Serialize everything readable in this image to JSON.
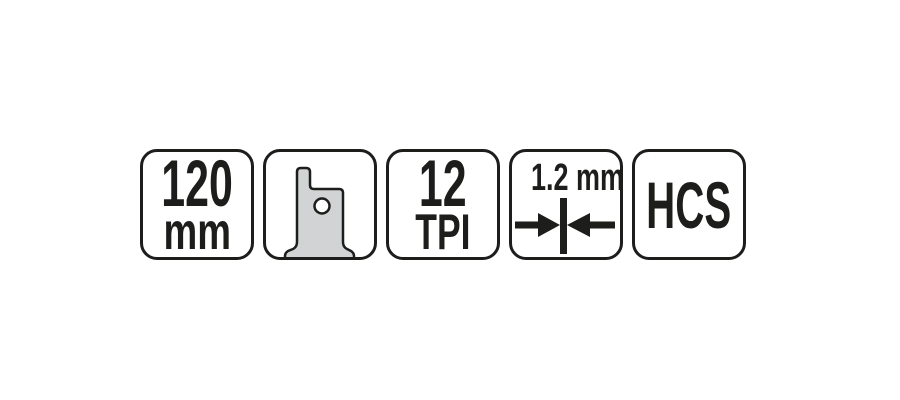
{
  "spec_badges": {
    "description": "Saw blade product specification pictogram strip",
    "colors": {
      "background": "#ffffff",
      "outline": "#1d1d1b",
      "text": "#1d1d1b",
      "blade_fill": "#d2d3d4"
    },
    "items": [
      {
        "name": "blade-length",
        "line1": "120",
        "line2": "mm"
      },
      {
        "name": "blade-profile",
        "icon": "saw-blade-profile-icon"
      },
      {
        "name": "teeth-per-inch",
        "line1": "12",
        "line2": "TPI"
      },
      {
        "name": "blade-thickness",
        "label": "1.2 mm",
        "icon": "thickness-dimension-arrows-icon"
      },
      {
        "name": "blade-material",
        "label": "HCS"
      }
    ]
  }
}
